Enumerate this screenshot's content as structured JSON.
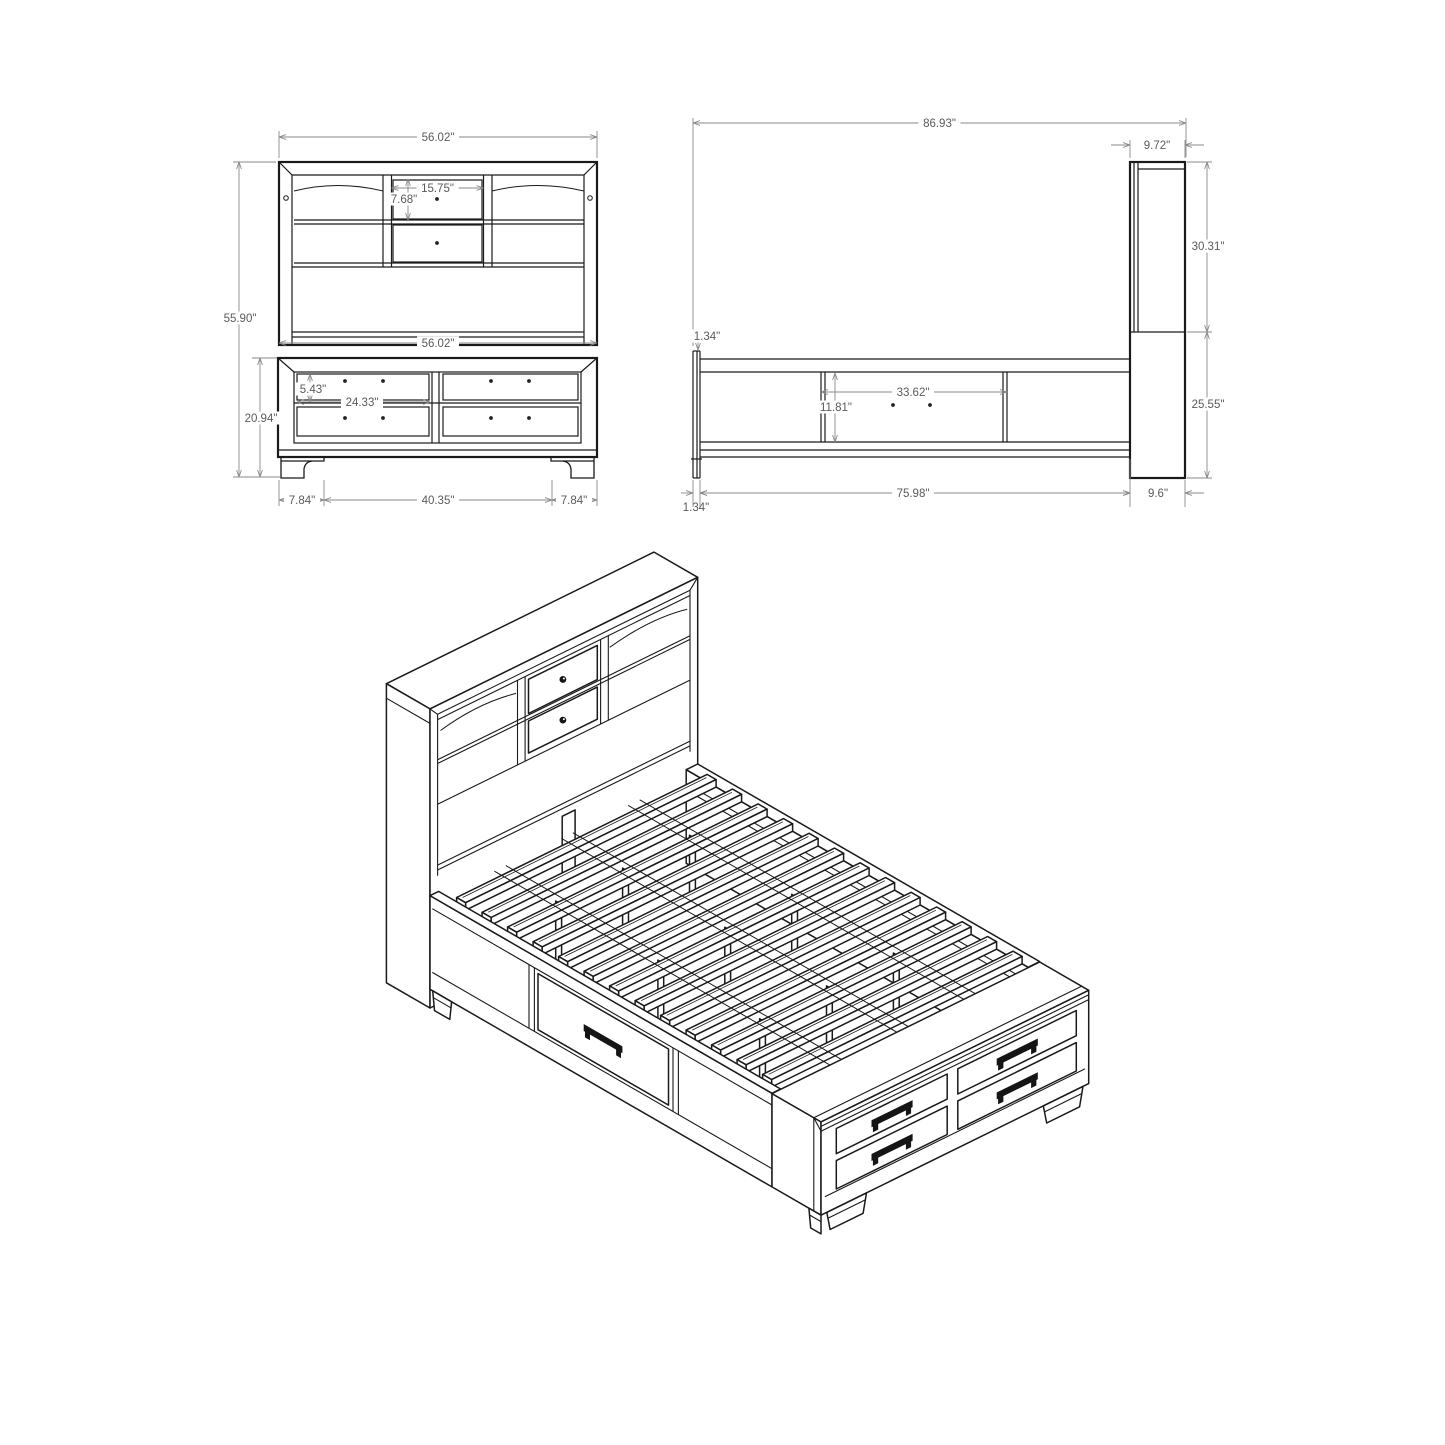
{
  "drawing": {
    "views": {
      "front": {
        "dims": {
          "overall_width": "56.02\"",
          "overall_height": "55.90\"",
          "shelf_drawer_width": "15.75\"",
          "shelf_drawer_height": "7.68\"",
          "base_width": "56.02\"",
          "base_drawer_height": "5.43\"",
          "base_drawer_width": "24.33\"",
          "base_height": "20.94\"",
          "foot_left": "7.84\"",
          "foot_span": "40.35\"",
          "foot_right": "7.84\""
        }
      },
      "side": {
        "dims": {
          "overall_length": "86.93\"",
          "headboard_depth": "9.72\"",
          "headboard_upper_height": "30.31\"",
          "footboard_thickness": "1.34\"",
          "drawer_width": "33.62\"",
          "drawer_height": "11.81\"",
          "headboard_lower_height": "25.55\"",
          "rail_inset": "1.34\"",
          "rail_length": "75.98\"",
          "headboard_base_depth": "9.6\""
        }
      }
    }
  }
}
